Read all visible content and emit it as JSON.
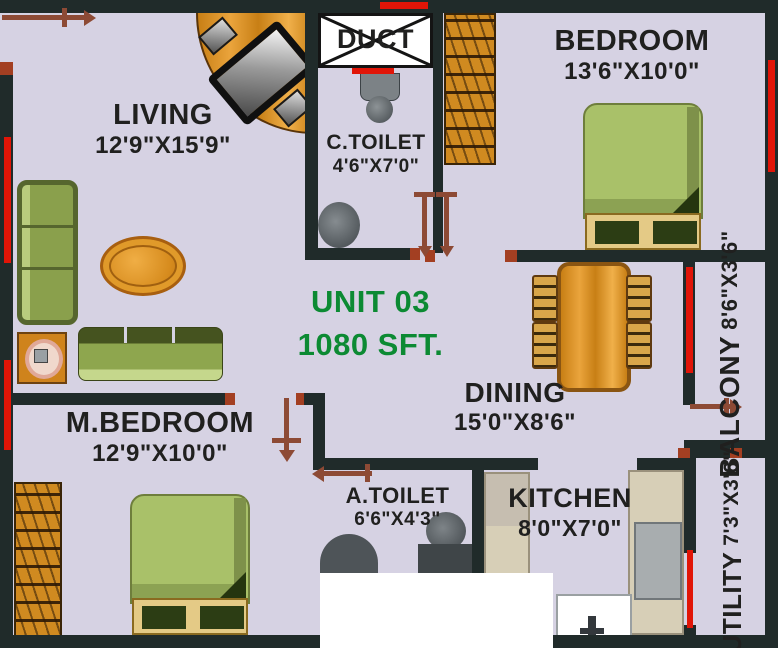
{
  "palette": {
    "floor": "#d6d2e3",
    "wall": "#202b2a",
    "win": "#e11507",
    "jamb": "#a33f22",
    "door": "#8d4a35",
    "ink": "#20201f",
    "green": "#0c8a33",
    "wood-dark": "#7c4a0e",
    "mattress": "#a9c169",
    "bed-base": "#e4ca86",
    "pillow": "#2c3d14",
    "sofa": "#8aa04c",
    "sofa-dark": "#56662e",
    "counter": "#d7cfb7",
    "fixture": "#565c60"
  },
  "unit": {
    "name": "UNIT 03",
    "area": "1080 SFT."
  },
  "rooms": {
    "living": {
      "label": "LIVING",
      "dims": "12'9\"X15'9\""
    },
    "duct": {
      "label": "DUCT"
    },
    "c_toilet": {
      "label": "C.TOILET",
      "dims": "4'6\"X7'0\""
    },
    "bedroom": {
      "label": "BEDROOM",
      "dims": "13'6\"X10'0\""
    },
    "dining": {
      "label": "DINING",
      "dims": "15'0\"X8'6\""
    },
    "balcony": {
      "label": "BALCONY",
      "dims": "8'6\"X3'6\""
    },
    "m_bedroom": {
      "label": "M.BEDROOM",
      "dims": "12'9\"X10'0\""
    },
    "a_toilet": {
      "label": "A.TOILET",
      "dims": "6'6\"X4'3\""
    },
    "kitchen": {
      "label": "KITCHEN",
      "dims": "8'0\"X7'0\""
    },
    "utility": {
      "label": "UTILITY",
      "dims": "7'3\"X3'6\""
    }
  }
}
